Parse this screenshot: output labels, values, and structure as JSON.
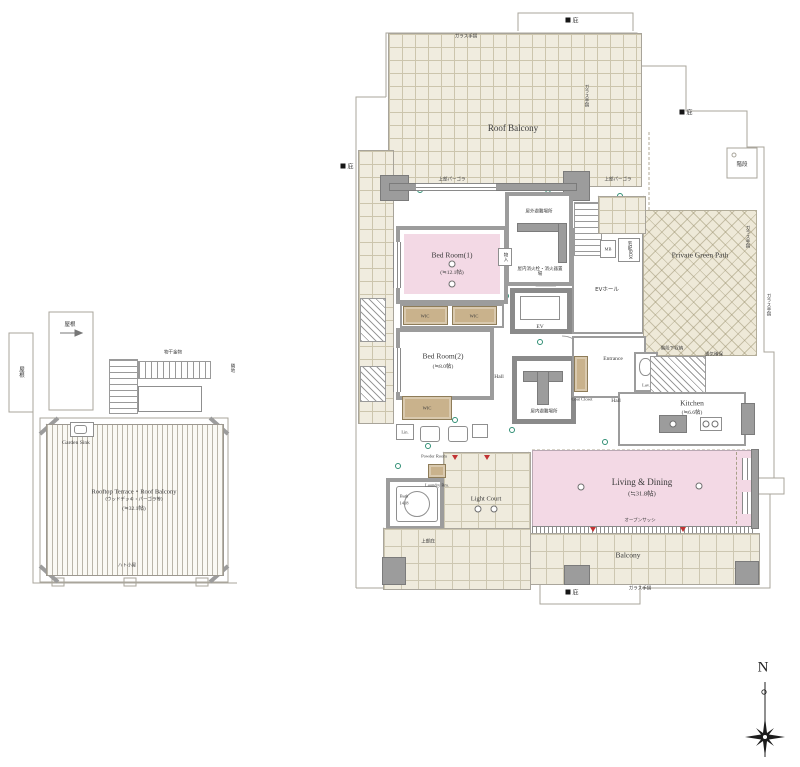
{
  "left_plan": {
    "roof_a": "屋根",
    "roof_b": "屋根",
    "hardware": "物干金物",
    "neighbor": "隣地",
    "garden_sink": "Garden Sink",
    "terrace_title": "Rooftop Terrace・Roof Balcony",
    "terrace_sub": "(ウッドデッキ・パーゴラ等)",
    "terrace_area": "(≒32.1帖)",
    "hatogoya": "ハト小屋"
  },
  "main_plan": {
    "roof_balcony": "Roof Balcony",
    "canopy": "庇",
    "stair_box": "階段",
    "glass_rail": "ガラス手摺",
    "pergola": "上部パーゴラ",
    "bedroom1_name": "Bed Room(1)",
    "bedroom1_area": "(≒12.1帖)",
    "bedroom2_name": "Bed Room(2)",
    "bedroom2_area": "(≒8.0帖)",
    "wic": "WIC",
    "lin": "Lin.",
    "refuge_out": "屋外避難場所",
    "refuge_in": "屋内避難場所",
    "extinguisher": "屋内消火栓・消火器置場",
    "monoire": "物入",
    "ev": "EV",
    "ev_hall": "EVホール",
    "mb": "MB",
    "parcel": "宅配BOX",
    "green_path": "Private Green Path",
    "entrance": "Entrance",
    "coat_closet": "Coat Closet",
    "hall": "Hall",
    "lav": "Lav.",
    "under_stair": "階段下収納",
    "vent": "通気確保",
    "kitchen_name": "Kitchen",
    "kitchen_area": "(≒6.6帖)",
    "ld_name": "Living & Dining",
    "ld_area": "(≒31.8帖)",
    "open_sash": "オープンサッシ",
    "balcony": "Balcony",
    "light_court": "Light Court",
    "upper_eaves": "上部庇",
    "bath": "Bath",
    "bath_size": "1418",
    "powder": "Powder Room",
    "laundry": "Laundry Rm."
  },
  "compass": {
    "n": "N"
  }
}
